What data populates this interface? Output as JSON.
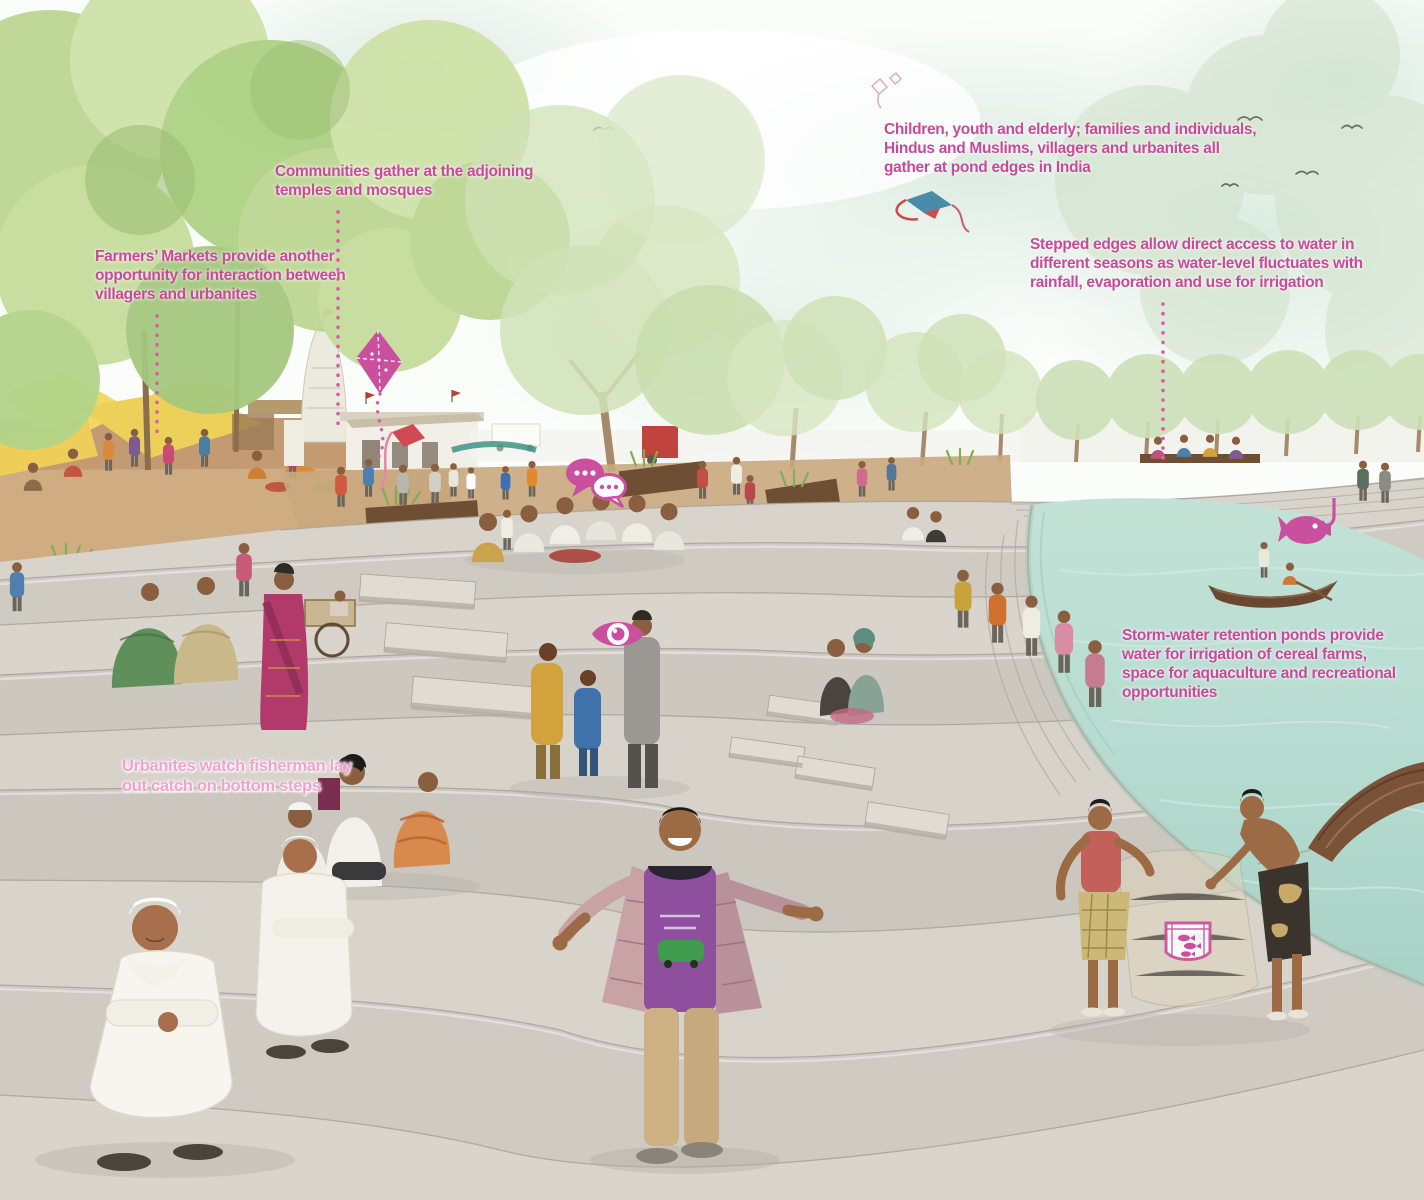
{
  "annotations": [
    {
      "id": "farmers-markets",
      "text": "Farmers’ Markets provide another\nopportunity for interaction between\nvillagers and urbanites"
    },
    {
      "id": "communities",
      "text": "Communities gather at the adjoining\ntemples and mosques"
    },
    {
      "id": "pond-gathering",
      "text": "Children, youth and elderly; families and individuals,\nHindus and Muslims, villagers and urbanites all\ngather at pond edges in India"
    },
    {
      "id": "stepped-edges",
      "text": "Stepped edges allow direct access to water in\ndifferent seasons as water-level fluctuates with\nrainfall, evaporation and use for irrigation"
    },
    {
      "id": "storm-water",
      "text": "Storm-water retention ponds provide\nwater for irrigation of cereal farms,\nspace for aquaculture and recreational\nopportunities"
    },
    {
      "id": "urbanites",
      "text": "Urbanites watch fisherman lay\nout catch on bottom steps"
    }
  ],
  "icons": [
    {
      "name": "kite-icon"
    },
    {
      "name": "chat-bubbles-icon"
    },
    {
      "name": "eye-icon"
    },
    {
      "name": "fish-hook-icon"
    },
    {
      "name": "fish-net-icon"
    }
  ],
  "colors": {
    "annotation_pink": "#c84a9a",
    "annotation_pink_light": "#f0a3ce",
    "icon_pink": "#cb4f9f",
    "water": "#b7dcd1",
    "step_light": "#dbd7cf",
    "step_mid": "#cbc6be",
    "foliage": "#bcd793",
    "market_ground": "#c69e74"
  }
}
